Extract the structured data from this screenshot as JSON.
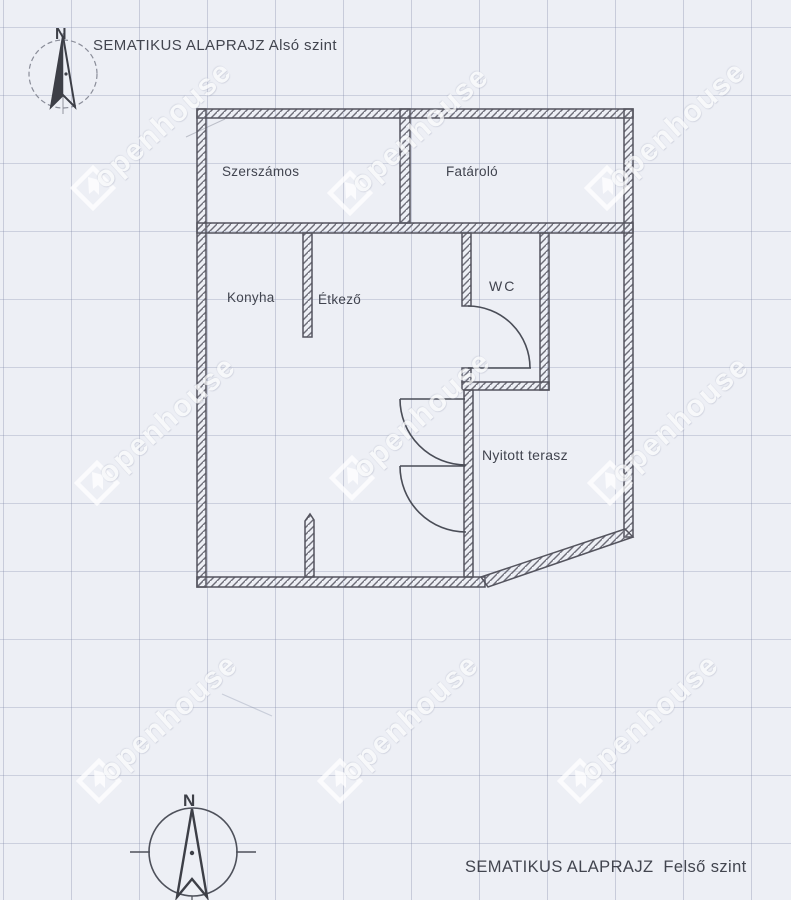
{
  "document": {
    "title_lower_level": "SEMATIKUS ALAPRAJZ Alsó szint",
    "title_upper_level": "SEMATIKUS ALAPRAJZ  Felső szint"
  },
  "compass": {
    "north_label": "N"
  },
  "floor_plan": {
    "rooms": {
      "szerszamos": "Szerszámos",
      "fatarolo": "Fatároló",
      "konyha": "Konyha",
      "etkezo": "Étkező",
      "wc": "WC",
      "nyitott_terasz": "Nyitott terasz"
    }
  },
  "watermark": {
    "text": "openhouse"
  },
  "colors": {
    "paper": "#edeff5",
    "grid_line": "#8b93b3",
    "ink": "#42454f",
    "wall_hatch": "#6d6d78"
  }
}
